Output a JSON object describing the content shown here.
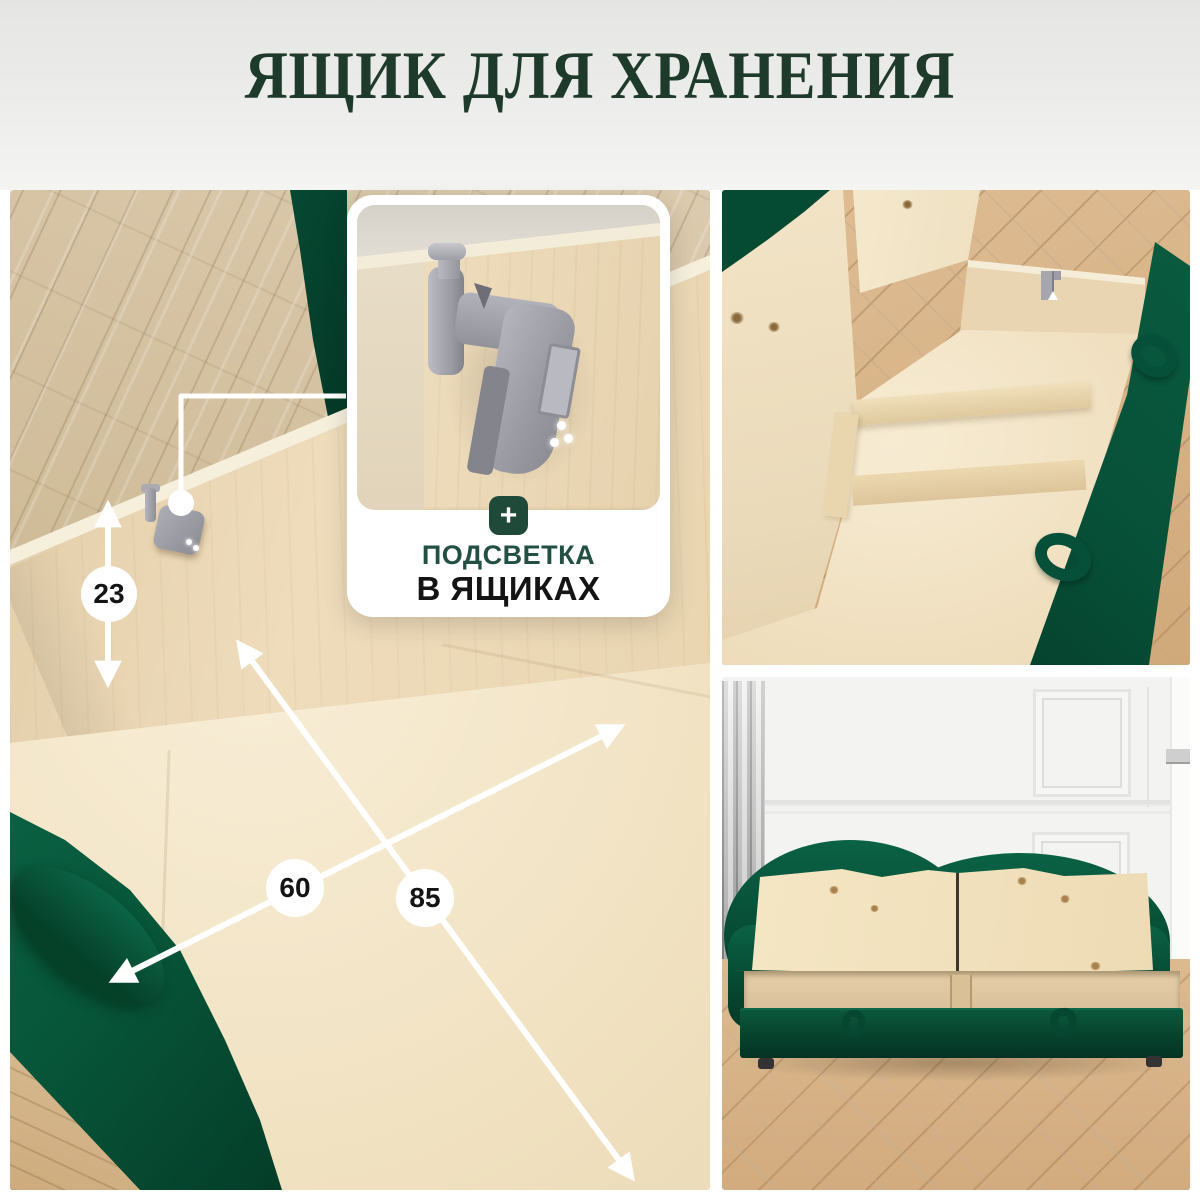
{
  "page": {
    "title": "ЯЩИК ДЛЯ ХРАНЕНИЯ"
  },
  "feature_card": {
    "plus_icon": "+",
    "line1": "ПОДСВЕТКА",
    "line2": "В ЯЩИКАХ"
  },
  "dimensions": {
    "height_cm": "23",
    "width_cm": "60",
    "length_cm": "85"
  },
  "colors": {
    "title_green": "#1e3a2b",
    "accent_green": "#1f4a39",
    "text_dark": "#141414",
    "fabric_green": "#07563a",
    "plywood": "#eedcbd",
    "oak_floor": "#d8c2a0",
    "annotation_white": "#ffffff",
    "hardware_gray": "#a2a2aa"
  }
}
